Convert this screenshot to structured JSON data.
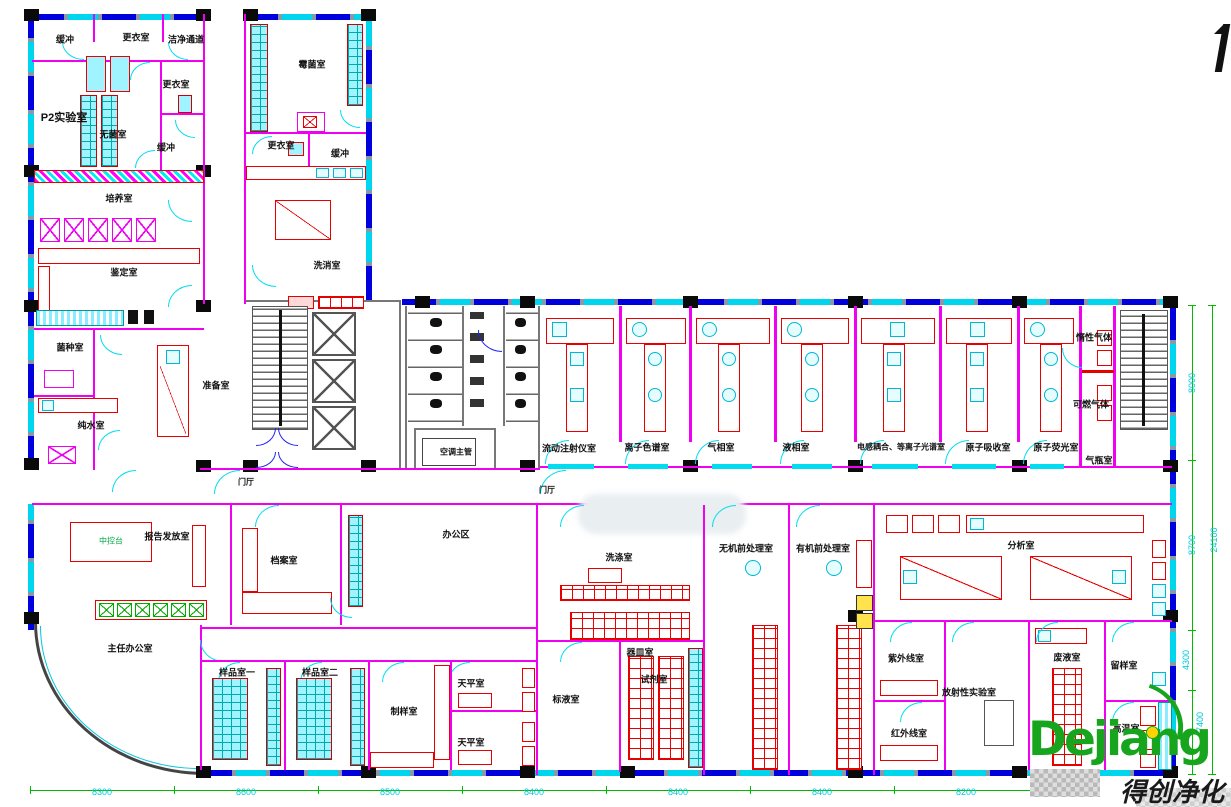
{
  "plan_title": "P2实验室平面布置图",
  "rooms": [
    {
      "label": "缓冲"
    },
    {
      "label": "更衣室"
    },
    {
      "label": "洁净通道"
    },
    {
      "label": "更衣室"
    },
    {
      "label": "P2实验室"
    },
    {
      "label": "无菌室"
    },
    {
      "label": "缓冲"
    },
    {
      "label": "培养室"
    },
    {
      "label": "鉴定室"
    },
    {
      "label": "菌种室"
    },
    {
      "label": "纯水室"
    },
    {
      "label": "准备室"
    },
    {
      "label": "霉菌室"
    },
    {
      "label": "更衣室"
    },
    {
      "label": "缓冲"
    },
    {
      "label": "洗消室"
    },
    {
      "label": "空调主管"
    },
    {
      "label": "门厅"
    },
    {
      "label": "门厅"
    },
    {
      "label": "流动注射仪室"
    },
    {
      "label": "离子色谱室"
    },
    {
      "label": "气相室"
    },
    {
      "label": "液相室"
    },
    {
      "label": "电感耦合、等离子光谱室"
    },
    {
      "label": "原子吸收室"
    },
    {
      "label": "原子荧光室"
    },
    {
      "label": "惰性气体"
    },
    {
      "label": "可燃气体"
    },
    {
      "label": "气瓶室"
    },
    {
      "label": "报告发放室"
    },
    {
      "label": "主任办公室"
    },
    {
      "label": "档案室"
    },
    {
      "label": "办公区"
    },
    {
      "label": "样品室一"
    },
    {
      "label": "样品室二"
    },
    {
      "label": "制样室"
    },
    {
      "label": "天平室"
    },
    {
      "label": "天平室"
    },
    {
      "label": "标液室"
    },
    {
      "label": "试剂室"
    },
    {
      "label": "器皿室"
    },
    {
      "label": "洗涤室"
    },
    {
      "label": "无机前处理室"
    },
    {
      "label": "有机前处理室"
    },
    {
      "label": "分析室"
    },
    {
      "label": "紫外线室"
    },
    {
      "label": "放射性实验室"
    },
    {
      "label": "红外线室"
    },
    {
      "label": "废液室"
    },
    {
      "label": "留样室"
    },
    {
      "label": "高温室"
    }
  ],
  "furniture_labels": [
    {
      "label": "中控台"
    }
  ],
  "dims": {
    "bottom": [
      "8300",
      "8600",
      "8500",
      "8400",
      "8400",
      "8400",
      "8200"
    ],
    "right": [
      "8000",
      "8700",
      "4300",
      "7400",
      "24100"
    ]
  },
  "watermark": {
    "logo": "Dejiang",
    "chinese": "得创净化"
  },
  "colors": {
    "wall": "#f000f0",
    "window": "#0000dd",
    "sill": "#00d5ee",
    "dimension": "#00bb00",
    "dimension_text": "#00c8d8",
    "bench": "#e80000",
    "column": "#0a0a0a",
    "logo_green": "#16a51c"
  }
}
